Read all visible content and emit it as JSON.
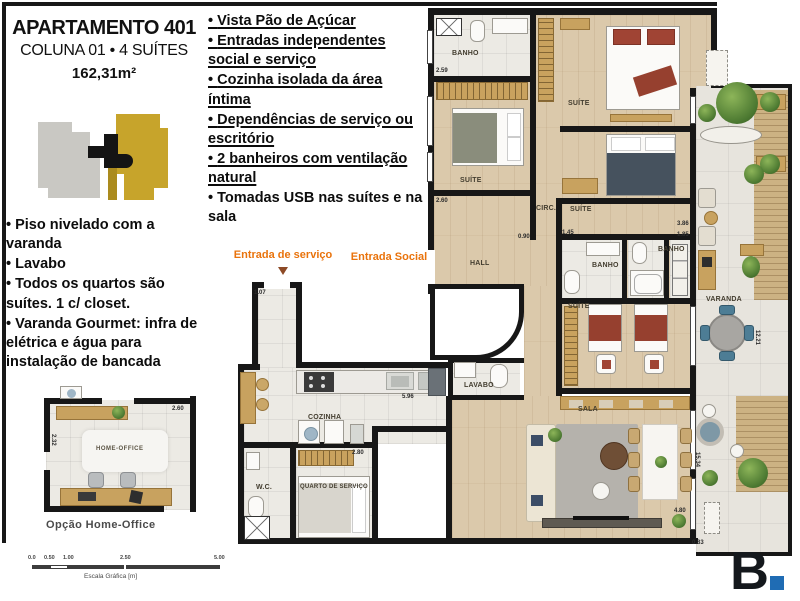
{
  "header": {
    "title": "APARTAMENTO 401",
    "subtitle": "COLUNA 01 • 4 SUÍTES",
    "area": "162,31m²"
  },
  "features_top": [
    "Vista Pão de Açúcar",
    "Entradas independentes social e serviço",
    "Cozinha isolada da área íntima",
    "Dependências de serviço ou escritório",
    "2 banheiros com ventilação natural",
    "Tomadas USB nas suítes e na sala"
  ],
  "features_left": [
    "Piso nivelado com a varanda",
    "Lavabo",
    "Todos os quartos são suítes. 1 c/ closet.",
    "Varanda Gourmet: infra de elétrica e água para instalação de bancada"
  ],
  "entrances": {
    "service": "Entrada de serviço",
    "social": "Entrada Social"
  },
  "rooms": {
    "banho": "BANHO",
    "suite": "SUÍTE",
    "circ": "CIRC.",
    "hall": "HALL",
    "varanda": "VARANDA",
    "lavabo": "LAVABO",
    "sala": "SALA",
    "cozinha": "COZINHA",
    "wc": "W.C.",
    "quarto_servico": "QUARTO DE SERVIÇO",
    "home_office": "HOME-OFFICE"
  },
  "dims": {
    "banho1": "2.59",
    "suite1": "2.60",
    "banho2": "1.45",
    "banho3": "1.85",
    "suite3": "3.86",
    "hall": "0.90",
    "cozinha": "5.96",
    "corredor": "1.07",
    "servico": "2.80",
    "varanda_len": "15.34",
    "varanda_w": "4.80",
    "varanda_b": "0.83",
    "varanda_side": "12.21",
    "ho_h": "2.32",
    "ho_w": "2.60"
  },
  "home_office": {
    "caption": "Opção Home-Office"
  },
  "scalebar": {
    "t0": "0.0",
    "t1": "0.50",
    "t2": "1.00",
    "t3": "2.50",
    "t4": "5.00",
    "label": "Escala Gráfica [m]"
  },
  "logo": {
    "letter": "B"
  },
  "colors": {
    "accent_orange": "#e9730c",
    "arrow_brown": "#8d4a26",
    "logo_blue": "#1f6cb4",
    "keyplan_gold": "#c7a42b",
    "keyplan_grey": "#c9c8c3"
  }
}
